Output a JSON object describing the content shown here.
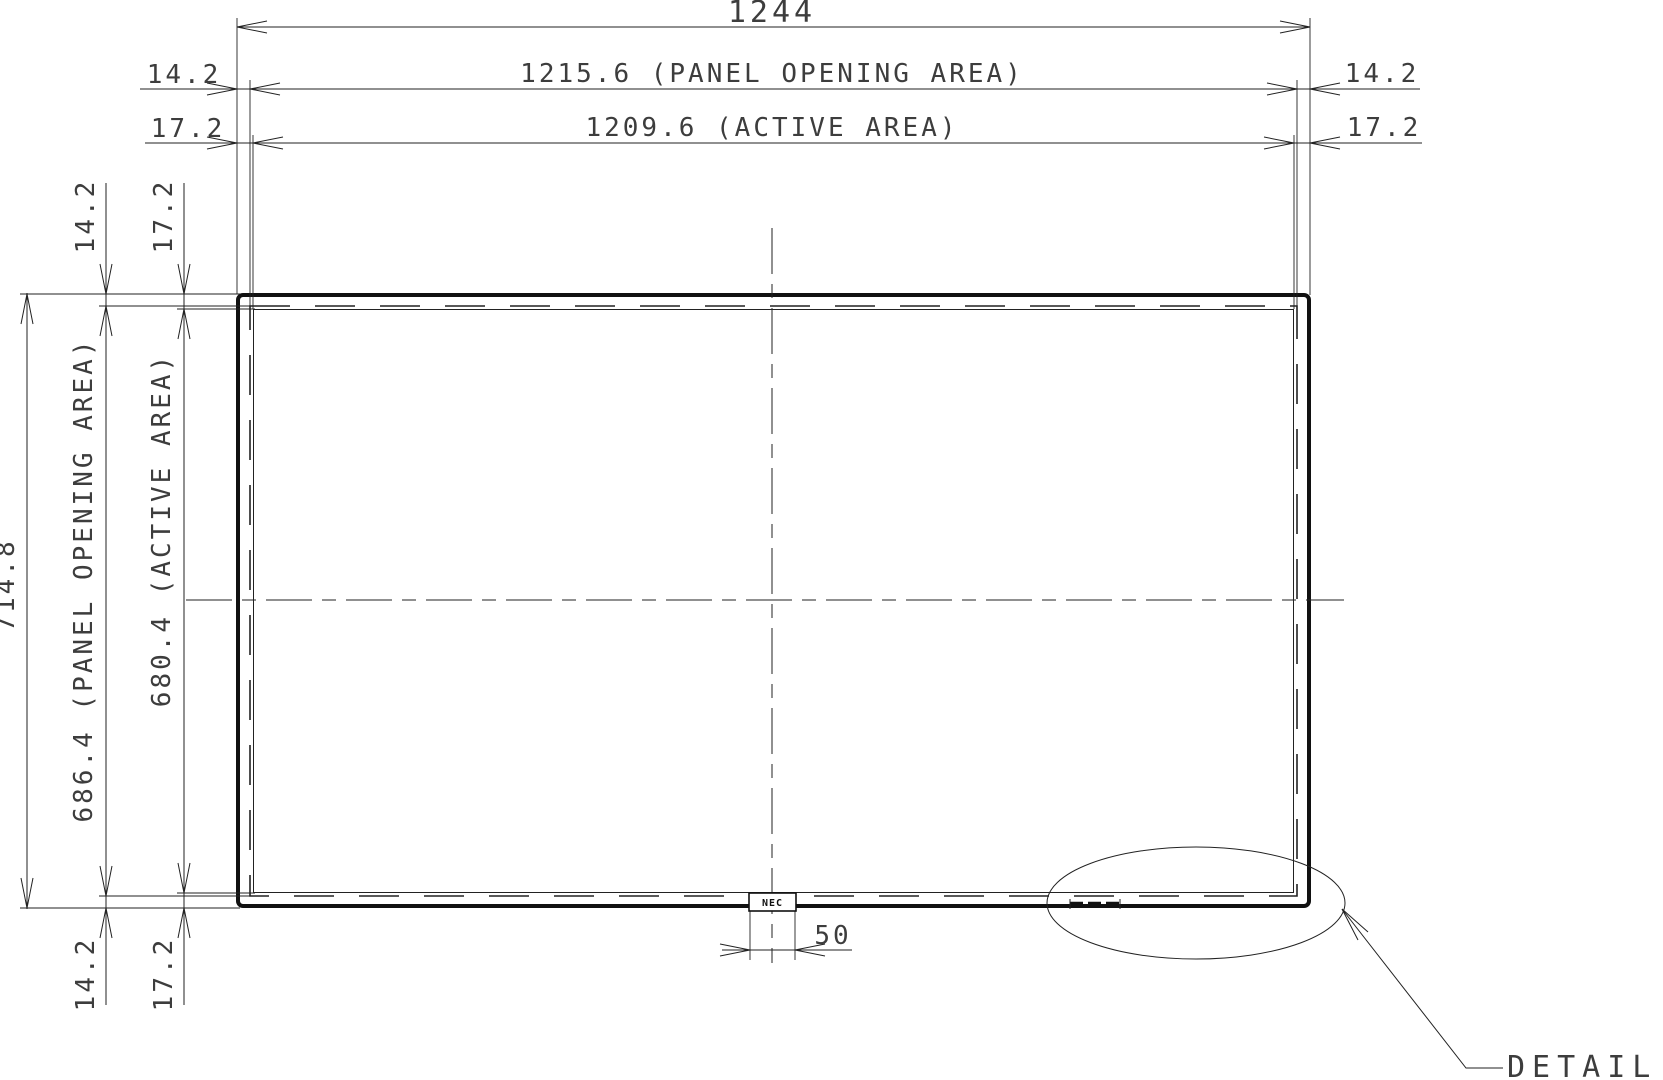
{
  "drawing": {
    "type": "display-panel-outline-dimension-drawing",
    "dims": {
      "total_width": "1244",
      "opening_width": "1215.6 (PANEL OPENING AREA)",
      "active_width": "1209.6 (ACTIVE AREA)",
      "total_height": "714.8",
      "opening_height": "686.4 (PANEL OPENING AREA)",
      "active_height": "680.4 (ACTIVE AREA)",
      "opening_margin": "14.2",
      "active_margin": "17.2",
      "logo_width": "50"
    },
    "labels": {
      "detail_callout": "DETAIL A",
      "logo": "NEC"
    }
  },
  "colors": {
    "line": "#222222",
    "text": "#3d3d3d",
    "thick_outline": "#111111",
    "background": "#ffffff"
  }
}
